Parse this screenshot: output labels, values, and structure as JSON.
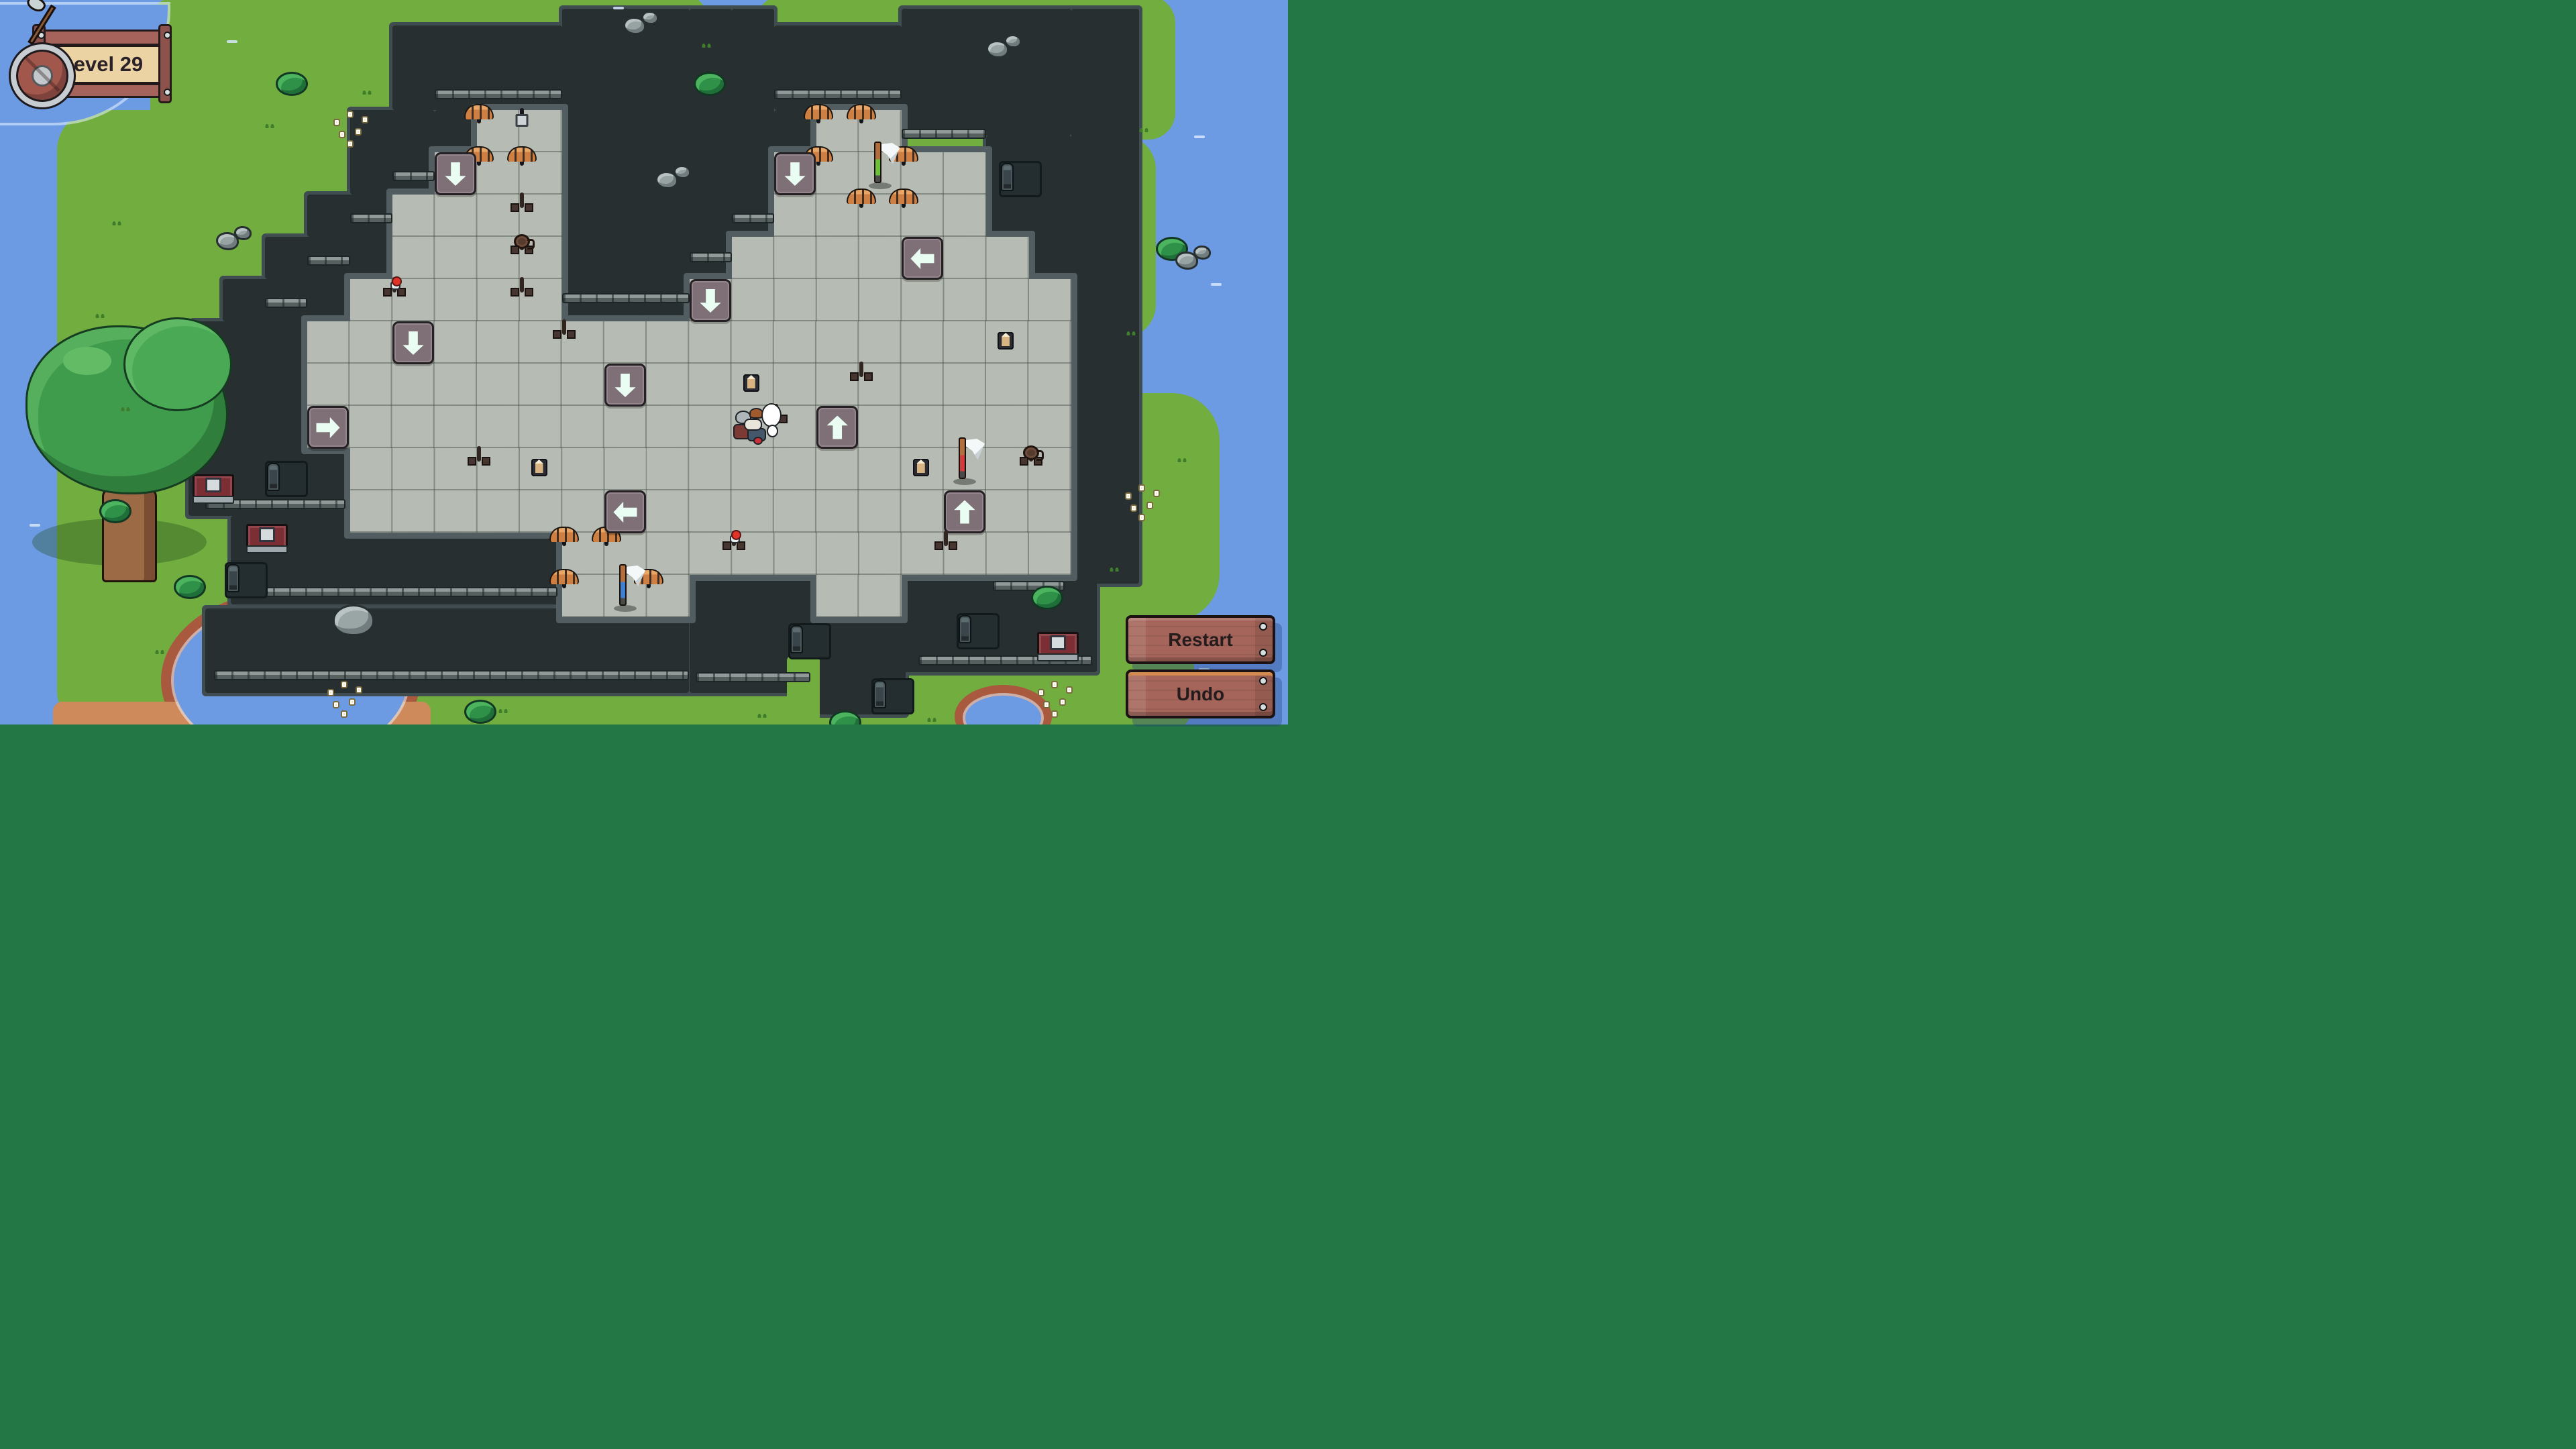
{
  "hud": {
    "level_label": "Level 29"
  },
  "buttons": [
    {
      "id": "restart",
      "label": "Restart"
    },
    {
      "id": "undo",
      "label": "Undo"
    }
  ],
  "palette": {
    "water": "#6c9be4",
    "grass": "#72ad40",
    "wall": "#272f31",
    "wall_rim": "#3f4c50",
    "floor": "#b6bbb3",
    "floor_rim": "#515d61",
    "arrow_mint": "#4ee0a5",
    "bed_blue": "#4da0ea",
    "bed_red": "#d63c44",
    "bed_green": "#83bb4a",
    "wood_button": "#a5655a",
    "sign_plaque": "#ecd3a4",
    "shore_red": "#a8593e",
    "shore_sand": "#cf8a5c"
  },
  "board": {
    "tile": {
      "w": 63.25,
      "h": 63,
      "ox": 15.5,
      "oy": 38
    },
    "grass": [
      [
        1.1,
        2.0,
        25.5,
        14.7,
        "60px"
      ],
      [
        3.3,
        -0.7,
        10.4,
        3.5,
        "40px"
      ],
      [
        13.1,
        -0.7,
        3.3,
        3.6,
        "30px"
      ],
      [
        17.55,
        -0.7,
        9.9,
        3.4,
        "40px"
      ],
      [
        25.5,
        2.6,
        1.5,
        4.8,
        "0 50px 50px 0"
      ],
      [
        25.5,
        8.7,
        3.0,
        5.4,
        "0 70px 70px 0"
      ],
      [
        24.0,
        13.6,
        3.9,
        3.2,
        "50px"
      ]
    ],
    "shores": [
      [
        3.55,
        13.35,
        6.1,
        4.3,
        "#a8593e",
        "50%"
      ],
      [
        1.0,
        16.0,
        8.9,
        1.0,
        "#cf8a5c",
        "14px"
      ],
      [
        22.25,
        15.6,
        2.3,
        1.5,
        "#a8593e",
        "50%"
      ]
    ],
    "water": [
      [
        3.85,
        13.65,
        5.5,
        3.7,
        "50%"
      ],
      [
        22.5,
        15.85,
        1.8,
        1.05,
        "50%"
      ],
      [
        -0.5,
        -0.5,
        4.2,
        2.8,
        "0 0 170px 0"
      ]
    ],
    "walls": [
      [
        9,
        0,
        4,
        2
      ],
      [
        10,
        2,
        1,
        1
      ],
      [
        8,
        2,
        2,
        2
      ],
      [
        7,
        4,
        2,
        1
      ],
      [
        6,
        5,
        3,
        1
      ],
      [
        5,
        6,
        3,
        1
      ],
      [
        4.3,
        7,
        2.7,
        1
      ],
      [
        4.3,
        8,
        2.7,
        2
      ],
      [
        4.2,
        10,
        3.8,
        1.6
      ],
      [
        5.2,
        11.6,
        7.8,
        2.1
      ],
      [
        4.6,
        13.8,
        11.4,
        2.0
      ],
      [
        16,
        13,
        2.95,
        2.8
      ],
      [
        18.95,
        14,
        2.15,
        2.3
      ],
      [
        21,
        13,
        4.6,
        2.3
      ],
      [
        13,
        -0.4,
        3,
        7.4
      ],
      [
        16,
        -0.4,
        1,
        6.4
      ],
      [
        17,
        -0.4,
        1,
        5.4
      ],
      [
        18,
        0,
        3,
        2
      ],
      [
        18,
        2,
        1,
        1
      ],
      [
        21,
        -0.4,
        4,
        3.0
      ],
      [
        23,
        2.6,
        2,
        2.4
      ],
      [
        24,
        2.6,
        1,
        3.4
      ],
      [
        25,
        -0.4,
        1.6,
        13.6
      ]
    ],
    "grass_after": [
      [
        18.3,
        14.9,
        0.78,
        1.6,
        "8px"
      ]
    ],
    "floors": [
      [
        11,
        2,
        2,
        2
      ],
      [
        10,
        3,
        3,
        1
      ],
      [
        9,
        4,
        4,
        2
      ],
      [
        8,
        6,
        5,
        1
      ],
      [
        7,
        7,
        8,
        3
      ],
      [
        8,
        10,
        7,
        2
      ],
      [
        13,
        12,
        3,
        2
      ],
      [
        19,
        2,
        2,
        1
      ],
      [
        18,
        3,
        5,
        2
      ],
      [
        17,
        5,
        7,
        1
      ],
      [
        16,
        6,
        9,
        1
      ],
      [
        15,
        7,
        10,
        5
      ],
      [
        16,
        12,
        9,
        1
      ],
      [
        19,
        13,
        2,
        1
      ]
    ],
    "ledges": [
      [
        10,
        1.5,
        3
      ],
      [
        18,
        1.5,
        3
      ],
      [
        13,
        6.34,
        3
      ],
      [
        16,
        5.36,
        1
      ],
      [
        21,
        2.44,
        2
      ],
      [
        17,
        4.44,
        1
      ],
      [
        9,
        3.45,
        1
      ],
      [
        8,
        4.45,
        1
      ],
      [
        7,
        5.45,
        1
      ],
      [
        6,
        6.45,
        1
      ],
      [
        4.6,
        11.2,
        3.3
      ],
      [
        5.4,
        13.28,
        7.5
      ],
      [
        4.8,
        15.25,
        11.2
      ],
      [
        16.15,
        15.3,
        2.7
      ],
      [
        21.4,
        14.9,
        4.1
      ],
      [
        23.15,
        13.15,
        1.7
      ]
    ],
    "doors": [
      [
        6.0,
        10.3
      ],
      [
        5.05,
        12.7
      ],
      [
        23.3,
        3.2
      ],
      [
        18.33,
        14.15
      ],
      [
        22.3,
        13.9
      ],
      [
        20.3,
        15.45
      ]
    ],
    "panels": [
      [
        4.3,
        10.62
      ],
      [
        5.55,
        11.8
      ],
      [
        24.2,
        14.35
      ]
    ],
    "items": [
      {
        "t": "bed",
        "color": "blue",
        "c": 11,
        "r": 2
      },
      {
        "t": "bed",
        "color": "blue",
        "c": 11,
        "r": 3
      },
      {
        "t": "bed",
        "color": "blue",
        "c": 12,
        "r": 3
      },
      {
        "t": "chest",
        "c": 12,
        "r": 2
      },
      {
        "t": "bed",
        "color": "red",
        "c": 19,
        "r": 2
      },
      {
        "t": "bed",
        "color": "red",
        "c": 20,
        "r": 2
      },
      {
        "t": "bed",
        "color": "red",
        "c": 19,
        "r": 3
      },
      {
        "t": "bed",
        "color": "red",
        "c": 21,
        "r": 3
      },
      {
        "t": "bed",
        "color": "red",
        "c": 20,
        "r": 4
      },
      {
        "t": "bed",
        "color": "red",
        "c": 21,
        "r": 4
      },
      {
        "t": "bed",
        "color": "green",
        "c": 13,
        "r": 12
      },
      {
        "t": "bed",
        "color": "green",
        "c": 14,
        "r": 12
      },
      {
        "t": "bed",
        "color": "green",
        "c": 13,
        "r": 13
      },
      {
        "t": "bed",
        "color": "green",
        "c": 15,
        "r": 13
      },
      {
        "t": "arrow",
        "dir": "down",
        "c": 10,
        "r": 3
      },
      {
        "t": "arrow",
        "dir": "down",
        "c": 18,
        "r": 3
      },
      {
        "t": "arrow",
        "dir": "down",
        "c": 16,
        "r": 6
      },
      {
        "t": "arrow",
        "dir": "down",
        "c": 9,
        "r": 7
      },
      {
        "t": "arrow",
        "dir": "down",
        "c": 14,
        "r": 8
      },
      {
        "t": "arrow",
        "dir": "left",
        "c": 21,
        "r": 5
      },
      {
        "t": "arrow",
        "dir": "left",
        "c": 14,
        "r": 11
      },
      {
        "t": "arrow",
        "dir": "right",
        "c": 7,
        "r": 9
      },
      {
        "t": "arrow",
        "dir": "up",
        "c": 19,
        "r": 9
      },
      {
        "t": "arrow",
        "dir": "up",
        "c": 22,
        "r": 11
      },
      {
        "t": "table",
        "c": 12,
        "r": 4
      },
      {
        "t": "table",
        "c": 12,
        "r": 6
      },
      {
        "t": "table",
        "c": 11,
        "r": 10
      },
      {
        "t": "table",
        "c": 18,
        "r": 9
      },
      {
        "t": "table",
        "c": 22,
        "r": 12
      },
      {
        "t": "table",
        "kind": "wide",
        "c": 13,
        "r": 7,
        "w": 2
      },
      {
        "t": "table",
        "kind": "tall",
        "c": 20,
        "r": 8,
        "h": 2
      },
      {
        "t": "table",
        "kind": "mug",
        "c": 12,
        "r": 5
      },
      {
        "t": "table",
        "kind": "mug",
        "c": 24,
        "r": 10
      },
      {
        "t": "table",
        "kind": "potion",
        "c": 9,
        "r": 6
      },
      {
        "t": "table",
        "kind": "potion",
        "c": 17,
        "r": 12
      },
      {
        "t": "candles",
        "c": 17,
        "r": 8
      },
      {
        "t": "candles",
        "c": 12,
        "r": 10
      },
      {
        "t": "candles",
        "c": 21,
        "r": 10
      },
      {
        "t": "candles",
        "c": 23,
        "r": 7
      },
      {
        "t": "axe",
        "color": "green",
        "c": 20,
        "r": 3
      },
      {
        "t": "axe",
        "color": "red",
        "c": 22,
        "r": 10
      },
      {
        "t": "axe",
        "color": "blue",
        "c": 14,
        "r": 13
      },
      {
        "t": "viking",
        "c": 17,
        "r": 9
      }
    ],
    "decor": [
      {
        "t": "tree",
        "c": 0.3,
        "r": 6.9
      },
      {
        "t": "bush",
        "c": 6.25,
        "r": 1.1
      },
      {
        "t": "bush",
        "c": 2.1,
        "r": 11.2
      },
      {
        "t": "bush",
        "c": 3.85,
        "r": 13.0
      },
      {
        "t": "bush",
        "c": 10.7,
        "r": 15.95
      },
      {
        "t": "bush",
        "c": 24.05,
        "r": 13.25
      },
      {
        "t": "bush",
        "c": 27.0,
        "r": 5.0
      },
      {
        "t": "bush",
        "c": 16.1,
        "r": 1.1
      },
      {
        "t": "bush",
        "c": 19.3,
        "r": 16.2
      },
      {
        "t": "rocks",
        "c": 14.45,
        "r": -0.35
      },
      {
        "t": "rocks",
        "c": 15.2,
        "r": 3.3
      },
      {
        "t": "rocks",
        "c": 23.0,
        "r": 0.2
      },
      {
        "t": "rocks",
        "c": 4.85,
        "r": 4.75
      },
      {
        "t": "rocks",
        "c": 27.45,
        "r": 5.2
      },
      {
        "t": "boulder",
        "c": 7.6,
        "r": 13.7
      },
      {
        "t": "flowers",
        "c": 26.2,
        "r": 10.8
      },
      {
        "t": "flowers",
        "c": 24.15,
        "r": 15.45
      },
      {
        "t": "flowers",
        "c": 7.4,
        "r": 15.45
      },
      {
        "t": "flowers",
        "c": 7.55,
        "r": 1.95
      },
      {
        "t": "tuft",
        "c": 6.0,
        "r": 2.3
      },
      {
        "t": "tuft",
        "c": 8.3,
        "r": 1.5
      },
      {
        "t": "tuft",
        "c": 2.4,
        "r": 4.6
      },
      {
        "t": "tuft",
        "c": 2.0,
        "r": 6.8
      },
      {
        "t": "tuft",
        "c": 16.3,
        "r": 0.4
      },
      {
        "t": "tuft",
        "c": 26.6,
        "r": 2.4
      },
      {
        "t": "tuft",
        "c": 27.5,
        "r": 10.2
      },
      {
        "t": "tuft",
        "c": 11.5,
        "r": 16.15
      },
      {
        "t": "tuft",
        "c": 17.6,
        "r": 16.25
      },
      {
        "t": "tuft",
        "c": 3.4,
        "r": 14.75
      },
      {
        "t": "tuft",
        "c": 25.9,
        "r": 12.8
      },
      {
        "t": "tuft",
        "c": 21.6,
        "r": 16.35
      },
      {
        "t": "tuft",
        "c": 2.6,
        "r": 9.0
      },
      {
        "t": "tuft",
        "c": 26.3,
        "r": 7.2
      },
      {
        "t": "sparkle",
        "c": 5.1,
        "r": 0.35
      },
      {
        "t": "sparkle",
        "c": 27.9,
        "r": 2.6
      },
      {
        "t": "sparkle",
        "c": 28.3,
        "r": 6.1
      },
      {
        "t": "sparkle",
        "c": 0.45,
        "r": 11.8
      },
      {
        "t": "sparkle",
        "c": 14.2,
        "r": -0.45
      },
      {
        "t": "sparkle",
        "c": 28.0,
        "r": 15.2
      }
    ]
  }
}
